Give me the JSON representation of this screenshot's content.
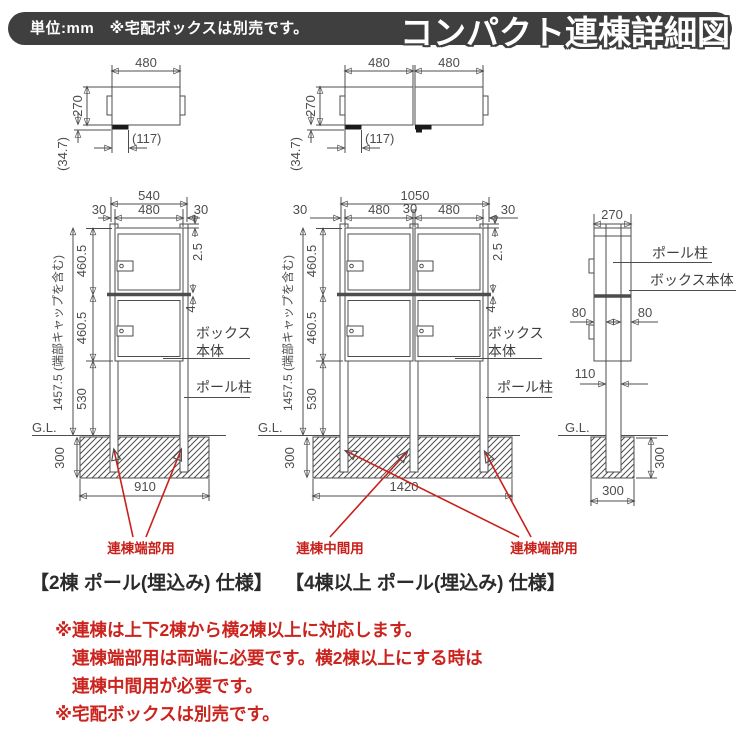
{
  "header": {
    "note": "単位:mm　※宅配ボックスは別売です。",
    "title": "コンパクト連棟詳細図"
  },
  "plan_single": {
    "dim_480": "480",
    "dim_270": "270",
    "dim_117": "(117)",
    "dim_347": "(34.7)"
  },
  "plan_double": {
    "dim_480_left": "480",
    "dim_480_right": "480",
    "dim_270": "270",
    "dim_117": "(117)",
    "dim_347": "(34.7)"
  },
  "front_two": {
    "dim_540": "540",
    "dim_30_left": "30",
    "dim_480": "480",
    "dim_30_right": "30",
    "dim_25": "2.5",
    "dim_4": "4",
    "dim_4605_top": "460.5",
    "dim_4605_bottom": "460.5",
    "dim_530": "530",
    "dim_total": "1457.5 (端部キャップを含む)",
    "dim_300": "300",
    "dim_910": "910",
    "gl": "G.L.",
    "label_box_line1": "ボックス",
    "label_box_line2": "本体",
    "label_pole": "ポール柱",
    "tag_end": "連棟端部用",
    "caption": "【2棟 ポール(埋込み) 仕様】"
  },
  "front_four": {
    "dim_1050": "1050",
    "dim_30_left": "30",
    "dim_480_left": "480",
    "dim_30_mid": "30",
    "dim_480_right": "480",
    "dim_30_right": "30",
    "dim_25": "2.5",
    "dim_4": "4",
    "dim_4605_top": "460.5",
    "dim_4605_bottom": "460.5",
    "dim_530": "530",
    "dim_total": "1457.5 (端部キャップを含む)",
    "dim_300": "300",
    "dim_1420": "1420",
    "gl": "G.L.",
    "label_box_line1": "ボックス",
    "label_box_line2": "本体",
    "label_pole": "ポール柱",
    "tag_mid": "連棟中間用",
    "tag_end": "連棟端部用",
    "caption": "【4棟以上 ポール(埋込み) 仕様】"
  },
  "side": {
    "dim_270": "270",
    "label_pole": "ポール柱",
    "label_box": "ボックス本体",
    "dim_80_left": "80",
    "dim_80_right": "80",
    "dim_110": "110",
    "gl": "G.L.",
    "dim_300_depth": "300",
    "dim_300_width": "300"
  },
  "notes": {
    "line1": "※連棟は上下2棟から横2棟以上に対応します。",
    "line2": "連棟端部用は両端に必要です。横2棟以上にする時は",
    "line3": "連棟中間用が必要です。",
    "line4": "※宅配ボックスは別売です。"
  },
  "colors": {
    "line": "#4d4d4d",
    "red": "#c9201b",
    "header_bg": "#3f3f3f"
  }
}
